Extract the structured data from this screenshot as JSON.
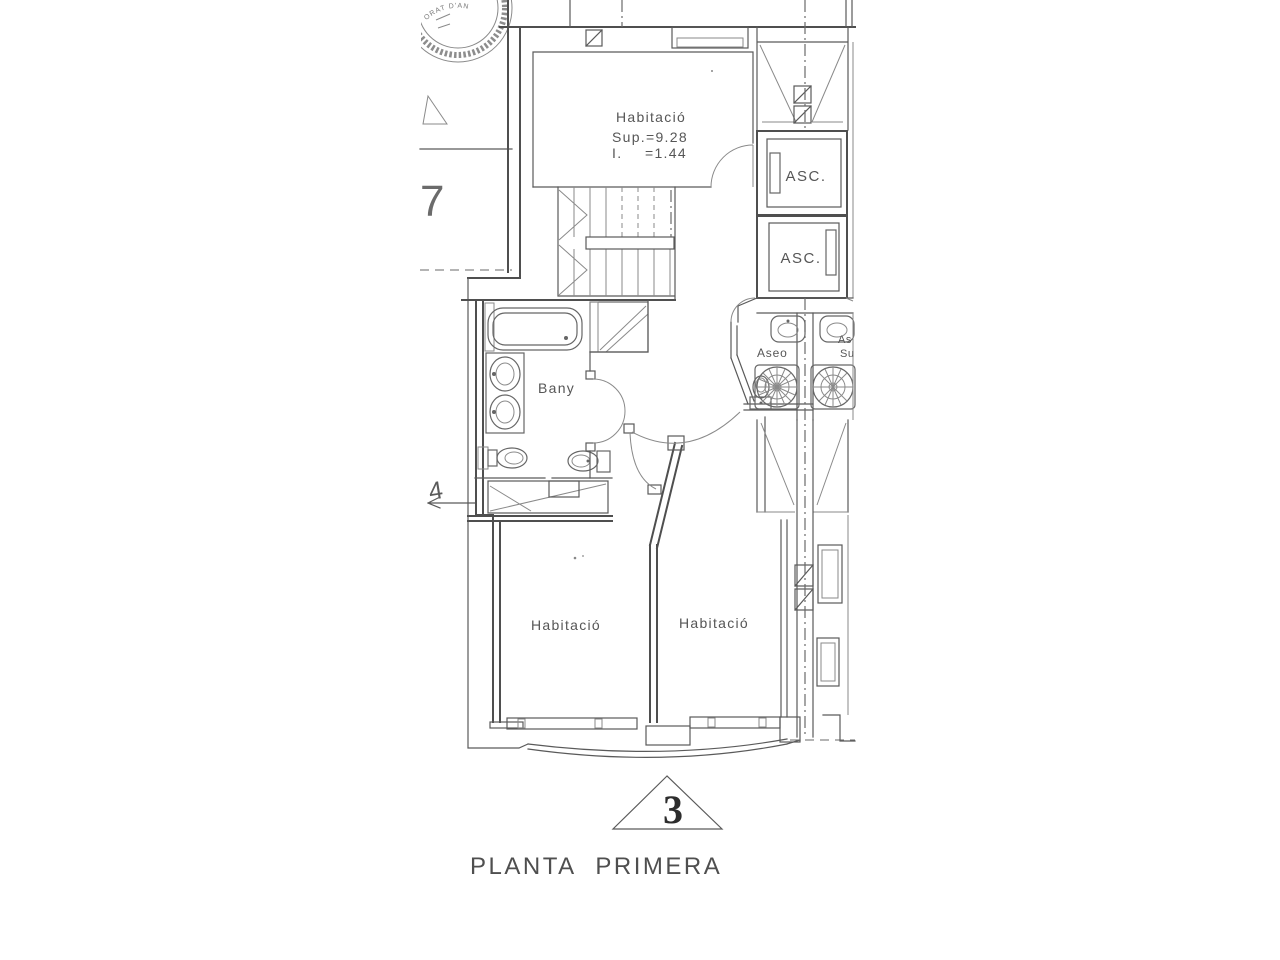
{
  "page": {
    "paper_color": "#ffffff",
    "ink_color": "#4f4f4f"
  },
  "plan": {
    "title": "PLANTA PRIMERA",
    "drawing_number": "3",
    "rooms": {
      "bedroom_top": {
        "label": "Habitació",
        "area": "Sup.=9.28",
        "dim_label": "I.",
        "dim_value": "=1.44"
      },
      "bathroom": {
        "label": "Bany"
      },
      "toilet": {
        "label": "Aseo"
      },
      "bedroom_left": {
        "label": "Habitació"
      },
      "bedroom_right": {
        "label": "Habitació"
      },
      "neighbor_fragment": {
        "line1": "As",
        "line2": "Su"
      }
    },
    "elevators": {
      "first": "ASC.",
      "second": "ASC."
    },
    "marks": {
      "level_upper": "7",
      "level_lower": "4"
    },
    "seal_fragment": "ORAT D'AN"
  }
}
